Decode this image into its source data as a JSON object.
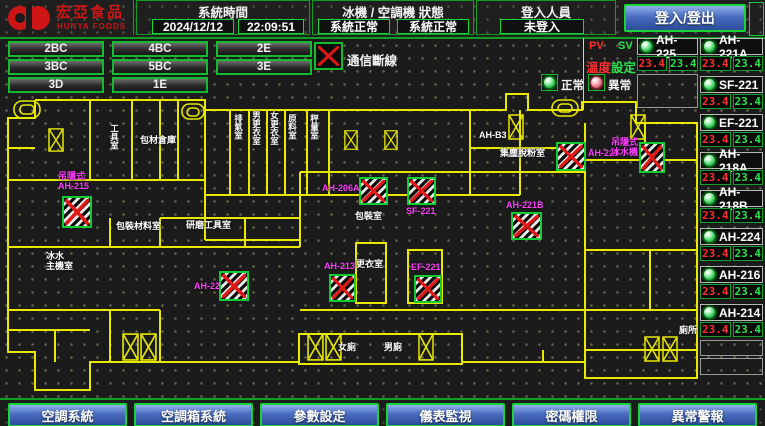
{
  "app": {
    "logo_title": "宏亞食品",
    "logo_subtitle": "HUNYA FOODS"
  },
  "header": {
    "system_time_label": "系統時間",
    "date": "2024/12/12",
    "time": "22:09:51",
    "machine_status_label": "冰機 / 空調機 狀態",
    "chiller_status": "系統正常",
    "ahu_status": "系統正常",
    "login_label": "登入人員",
    "login_user": "未登入",
    "login_button": "登入/登出"
  },
  "floor_buttons": [
    "2BC",
    "4BC",
    "2E",
    "3BC",
    "5BC",
    "3E",
    "3D",
    "1E"
  ],
  "legend": {
    "comm_lost": "通信斷線",
    "normal": "正常",
    "abnormal": "異常"
  },
  "equipment": {
    "pv_label": "PV",
    "sv_label": "SV",
    "setpoint_label_red": "溫度",
    "setpoint_label_green": "設定",
    "top_left": {
      "name": "AH-225",
      "pv": "23.4",
      "sv": "23.4"
    },
    "top_right": {
      "name": "AH-221A",
      "pv": "23.4",
      "sv": "23.4"
    },
    "rows": [
      {
        "name": "SF-221",
        "pv": "23.4",
        "sv": "23.4"
      },
      {
        "name": "EF-221",
        "pv": "23.4",
        "sv": "23.4"
      },
      {
        "name": "AH-218A",
        "pv": "23.4",
        "sv": "23.4"
      },
      {
        "name": "AH-218B",
        "pv": "23.4",
        "sv": "23.4"
      },
      {
        "name": "AH-224",
        "pv": "23.4",
        "sv": "23.4"
      },
      {
        "name": "AH-216",
        "pv": "23.4",
        "sv": "23.4"
      },
      {
        "name": "AH-214",
        "pv": "23.4",
        "sv": "23.4"
      }
    ]
  },
  "plan": {
    "rooms": [
      {
        "t": "工具室",
        "x": 109,
        "y": 124,
        "v": true
      },
      {
        "t": "包材倉庫",
        "x": 140,
        "y": 136
      },
      {
        "t": "排氣室",
        "x": 233,
        "y": 114,
        "v": true
      },
      {
        "t": "男更衣室",
        "x": 251,
        "y": 111,
        "v": true
      },
      {
        "t": "女更衣室",
        "x": 269,
        "y": 111,
        "v": true
      },
      {
        "t": "原料室",
        "x": 287,
        "y": 114,
        "v": true
      },
      {
        "t": "秤量室",
        "x": 309,
        "y": 114,
        "v": true
      },
      {
        "t": "AH-B3",
        "x": 479,
        "y": 131
      },
      {
        "t": "集塵脫粉室",
        "x": 500,
        "y": 149
      },
      {
        "t": "包裝材料室",
        "x": 116,
        "y": 222
      },
      {
        "t": "研磨工具室",
        "x": 186,
        "y": 221
      },
      {
        "t": "冰水\n主機室",
        "x": 46,
        "y": 252
      },
      {
        "t": "包裝室",
        "x": 355,
        "y": 212
      },
      {
        "t": "更衣室",
        "x": 356,
        "y": 260
      },
      {
        "t": "女廁",
        "x": 338,
        "y": 343
      },
      {
        "t": "男廁",
        "x": 384,
        "y": 343
      },
      {
        "t": "廁所",
        "x": 679,
        "y": 326
      }
    ],
    "devices": [
      {
        "label": "吊隱式\nAH-215",
        "lx": 58,
        "ly": 172,
        "x": 62,
        "y": 196,
        "w": 30,
        "h": 32
      },
      {
        "label": "AH-206A",
        "lx": 322,
        "ly": 184,
        "x": 359,
        "y": 177,
        "w": 29,
        "h": 28
      },
      {
        "label": "SF-221",
        "lx": 406,
        "ly": 207,
        "x": 407,
        "y": 177,
        "w": 29,
        "h": 28
      },
      {
        "label": "AH-221B",
        "lx": 506,
        "ly": 201,
        "x": 511,
        "y": 212,
        "w": 31,
        "h": 28
      },
      {
        "label": "AH-224",
        "lx": 588,
        "ly": 149,
        "x": 556,
        "y": 142,
        "w": 30,
        "h": 29
      },
      {
        "label": "吊隱式\n冰水機",
        "lx": 611,
        "ly": 138,
        "x": 639,
        "y": 142,
        "w": 26,
        "h": 31
      },
      {
        "label": "AH-220",
        "lx": 194,
        "ly": 282,
        "x": 219,
        "y": 271,
        "w": 30,
        "h": 30
      },
      {
        "label": "AH-213",
        "lx": 324,
        "ly": 262,
        "x": 329,
        "y": 274,
        "w": 27,
        "h": 28
      },
      {
        "label": "EF-221",
        "lx": 411,
        "ly": 263,
        "x": 414,
        "y": 275,
        "w": 28,
        "h": 28
      }
    ]
  },
  "footer_buttons": [
    "空調系統",
    "空調箱系統",
    "參數設定",
    "儀表監視",
    "密碼權限",
    "異常警報"
  ],
  "colors": {
    "accent_green": "#13bb2e",
    "wall_yellow": "#e8e800",
    "device_magenta": "#ff3dff",
    "pv_red": "#ff2d2d",
    "sv_green": "#2ae24e",
    "alarm_x_red": "#e01818",
    "button_blue": "#4a6cc0",
    "logo_red": "#cf1616"
  }
}
